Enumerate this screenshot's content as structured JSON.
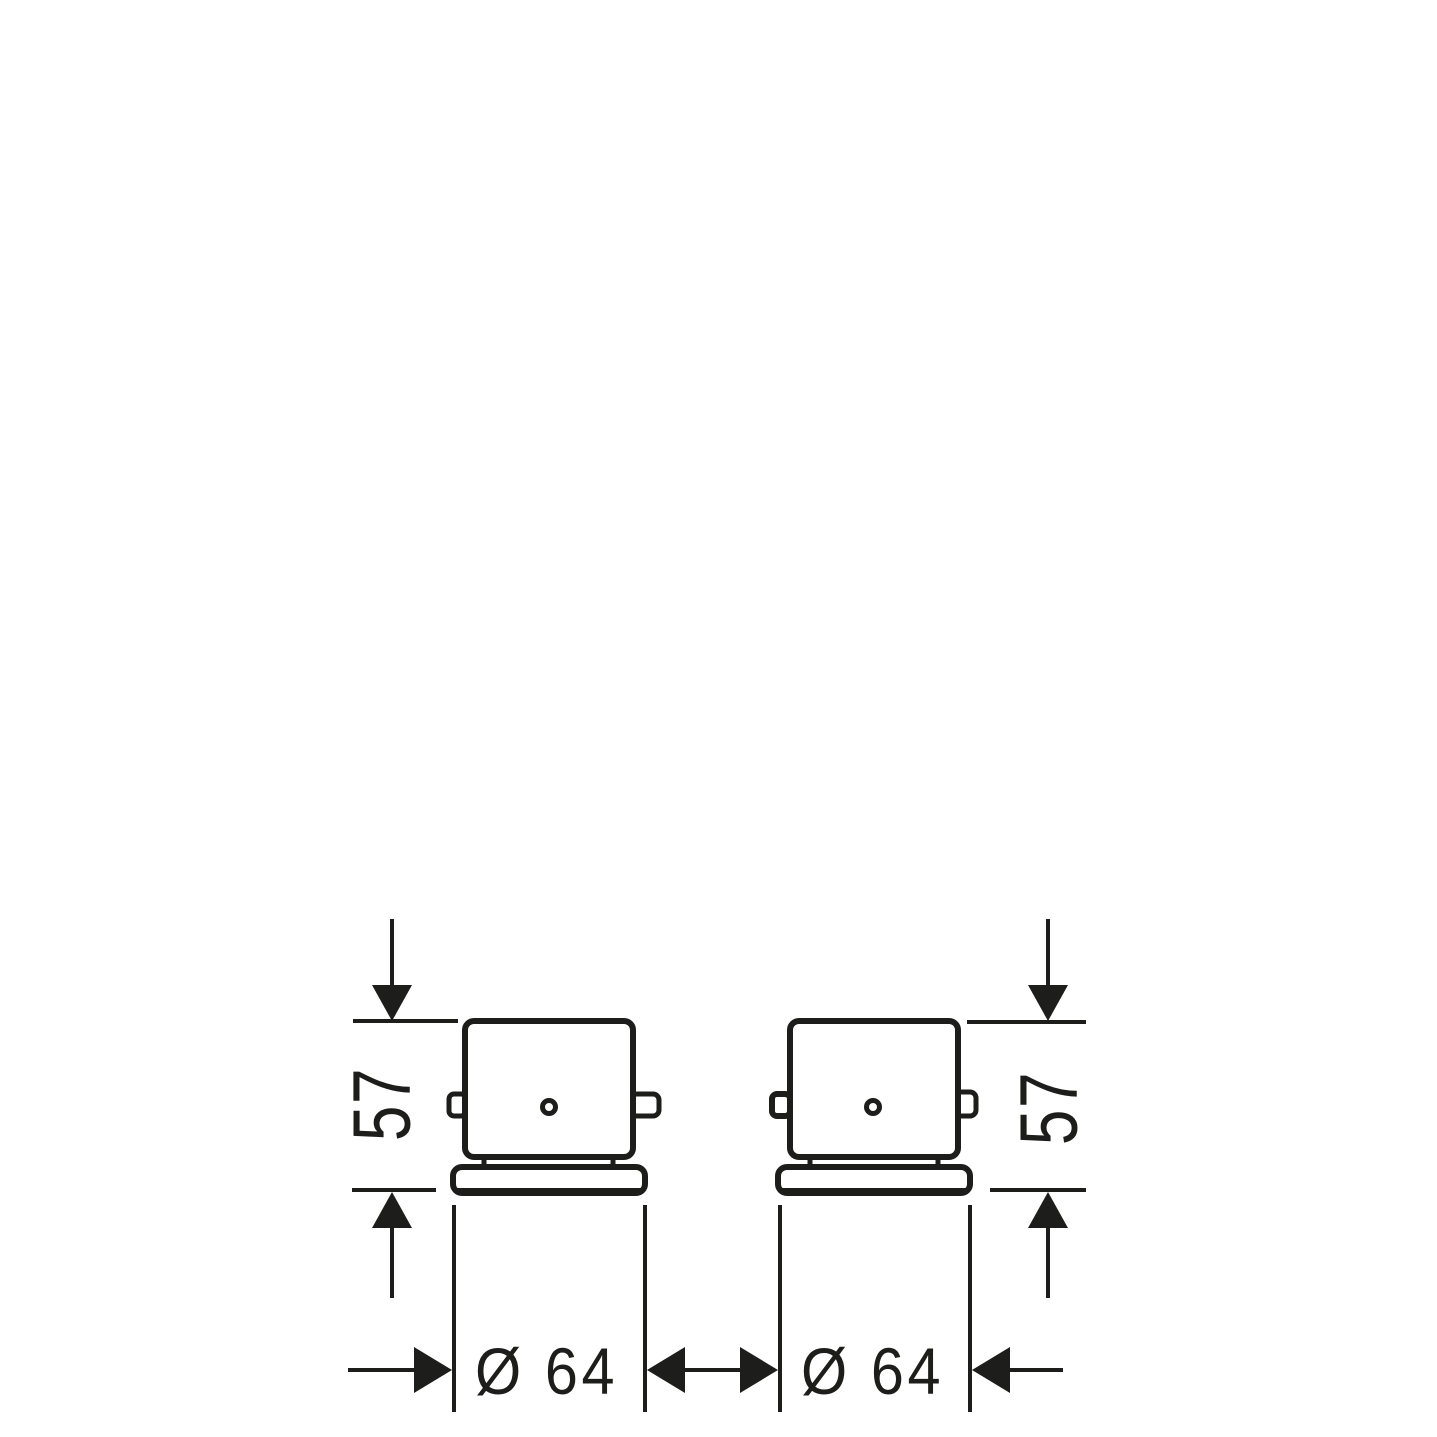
{
  "diagram": {
    "background_color": "#ffffff",
    "line_color": "#1d1d1b",
    "labels": {
      "left_height": "57",
      "right_height": "57",
      "left_diameter": "Ø 64",
      "right_diameter": "Ø 64"
    }
  }
}
